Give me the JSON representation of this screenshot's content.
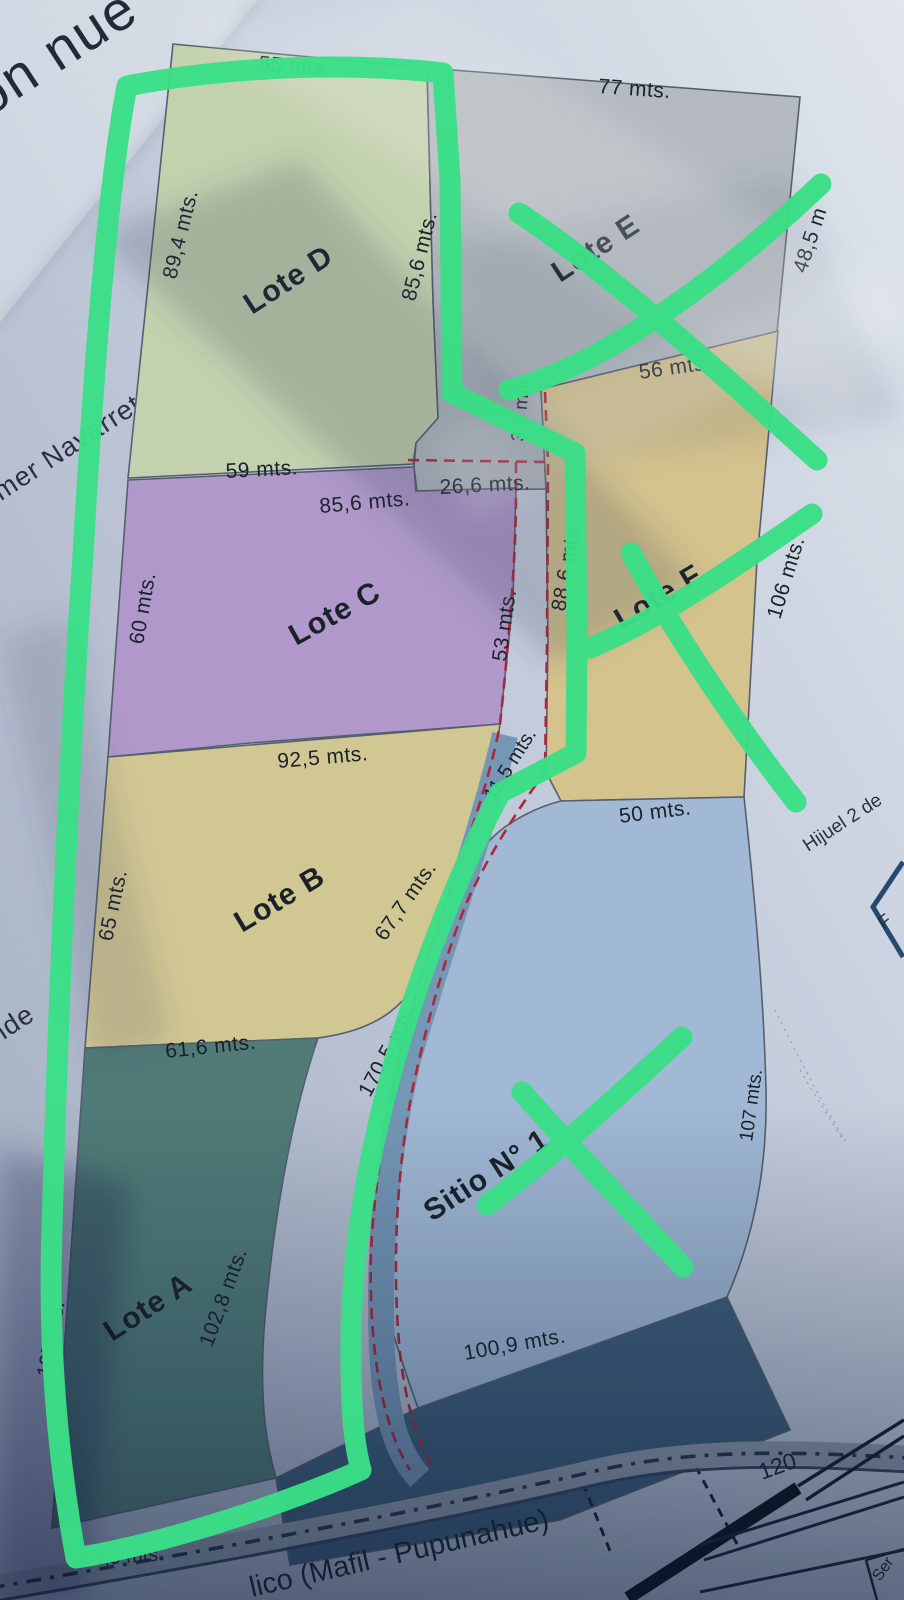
{
  "photo": {
    "background_text": {
      "plan_title_fragment": "on nue",
      "neighbor_name_fragment": "lmer Navarrete",
      "neighbor_name_fragment_2": "nde",
      "hijuela_fragment": "Hijuel 2 de",
      "corner_box_letter": "F",
      "table_cell_fragment": "Ser"
    },
    "lots": {
      "lote_d": {
        "name": "Lote D",
        "top": "55 mts.",
        "left": "89,4 mts.",
        "right": "85,6 mts.",
        "bottom": "59 mts."
      },
      "lote_e": {
        "name": "Lote E",
        "top": "77 mts.",
        "right": "48,5 m"
      },
      "lote_f": {
        "name": "Lote F",
        "top": "56 mts.",
        "upper_left": "3,9 mts.",
        "left": "88,6 mts.",
        "right": "106 mts.",
        "bottom": "50 mts."
      },
      "lote_c": {
        "name": "Lote C",
        "notch_top": "26,6 mts.",
        "top": "85,6 mts.",
        "left": "60 mts.",
        "right": "53 mts.",
        "bottom": "92,5 mts."
      },
      "lote_b": {
        "name": "Lote B",
        "left": "65 mts.",
        "right_upper": "11,5 mts.",
        "right_lower": "67,7 mts.",
        "bottom": "61,6 mts."
      },
      "sitio_1": {
        "name": "Sitio N° 1",
        "upper_left": "170,5 mts.",
        "right": "107 mts.",
        "bottom": "100,9 mts."
      },
      "lote_a": {
        "name": "Lote A",
        "left": "105 mts.",
        "river_side": "102,8 mts.",
        "bottom": "64,5 mts."
      }
    },
    "road": {
      "name_fragment": "lico (Mafil - Pupunahue)",
      "scale_value": "120"
    },
    "marker_annotations": {
      "tool": "green-marker",
      "shapes": [
        "enclosure-outline-around-lote-a-b-c-d",
        "cross-over-lote-e",
        "cross-over-lote-f",
        "cross-over-sitio-1"
      ]
    },
    "colors": {
      "marker_green": "#3ce98b",
      "dashed_red": "#b5283a",
      "lote_d": "#cedbb5",
      "lote_e": "#bdc2c7",
      "lote_f": "#e0cc92",
      "lote_c": "#b9a0d2",
      "lote_b": "#dbd098",
      "sitio_1": "#a9c1dd",
      "lote_a": "#54807b",
      "river": "#7b9dbd"
    }
  }
}
